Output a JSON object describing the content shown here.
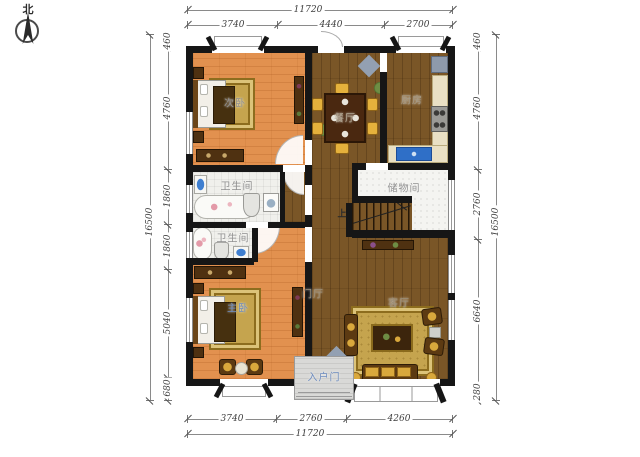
{
  "compass": {
    "label": "北"
  },
  "rooms": {
    "bedroom_secondary": "次卧",
    "dining": "餐厅",
    "kitchen": "厨房",
    "bathroom_top": "卫生间",
    "bathroom_bottom": "卫生间",
    "storage": "储物间",
    "bedroom_master": "主卧",
    "foyer": "门厅",
    "living": "客厅",
    "entrance": "入户门",
    "stairs_up": "上"
  },
  "dimensions": {
    "top": {
      "total": "11720",
      "segments": [
        "3740",
        "4440",
        "2700"
      ]
    },
    "bottom": {
      "total": "11720",
      "segments": [
        "3740",
        "2760",
        "4260"
      ]
    },
    "left": {
      "total": "16500",
      "segments": [
        "460",
        "4760",
        "1860",
        "1860",
        "5040",
        "680"
      ]
    },
    "right": {
      "total": "16500",
      "segments": [
        "460",
        "4760",
        "2760",
        "6640",
        "280"
      ]
    }
  },
  "colors": {
    "wall": "#161616",
    "floor_wood_dark": "#7a5627",
    "floor_wood_orange": "#e2914f",
    "floor_tile": "#f0f0ec",
    "rug_gold": "#c5a44e",
    "sink_blue": "#2f6fc7",
    "decor_gray_blue": "#93a0b2",
    "label_gray": "#8f8f8f",
    "label_blue": "#6d8cbf"
  }
}
